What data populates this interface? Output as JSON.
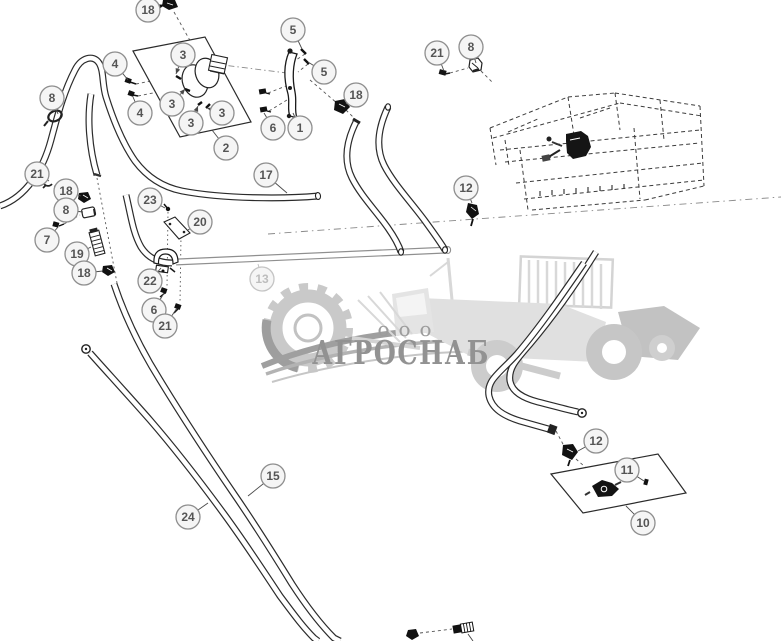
{
  "diagram": {
    "kind": "exploded-parts-diagram",
    "background": "#ffffff",
    "line_color": "#2b2b2b",
    "muted_line_color": "#8f8f8f"
  },
  "watermark": {
    "company_prefix": "ооо",
    "company_name": "АГРОСНАБ",
    "light": "#d9d9d9",
    "mid": "#c7c7c7",
    "dark": "#9a9a9a",
    "text_color": "#929292"
  },
  "callout_style": {
    "radius": 12,
    "fill": "#f5f5f5",
    "stroke": "#8e8e8e",
    "text": "#555555",
    "muted_stroke": "#c4c4c4",
    "muted_text": "#bdbdbd",
    "leader": "#4a4a4a"
  },
  "callouts": [
    {
      "label": "18",
      "x": 148,
      "y": 10,
      "lx": 164,
      "ly": 5,
      "arrow": true,
      "bold": true
    },
    {
      "label": "4",
      "x": 115,
      "y": 64,
      "lx": 128,
      "ly": 80
    },
    {
      "label": "4",
      "x": 140,
      "y": 113,
      "lx": 133,
      "ly": 97
    },
    {
      "label": "3",
      "x": 183,
      "y": 55,
      "lx": 176,
      "ly": 74,
      "arrow": true
    },
    {
      "label": "3",
      "x": 172,
      "y": 104,
      "lx": 185,
      "ly": 89,
      "arrow": true
    },
    {
      "label": "3",
      "x": 191,
      "y": 123,
      "lx": 198,
      "ly": 106,
      "arrow": true
    },
    {
      "label": "3",
      "x": 222,
      "y": 113,
      "lx": 207,
      "ly": 108,
      "arrow": true
    },
    {
      "label": "2",
      "x": 226,
      "y": 148,
      "lx": 212,
      "ly": 130
    },
    {
      "label": "5",
      "x": 293,
      "y": 30,
      "lx": 302,
      "ly": 49
    },
    {
      "label": "5",
      "x": 324,
      "y": 72,
      "lx": 308,
      "ly": 62
    },
    {
      "label": "6",
      "x": 273,
      "y": 128,
      "lx": 264,
      "ly": 113
    },
    {
      "label": "1",
      "x": 300,
      "y": 128,
      "lx": 293,
      "ly": 113
    },
    {
      "label": "18",
      "x": 356,
      "y": 95,
      "lx": 346,
      "ly": 104
    },
    {
      "label": "21",
      "x": 437,
      "y": 53,
      "lx": 444,
      "ly": 71
    },
    {
      "label": "8",
      "x": 471,
      "y": 47,
      "lx": 476,
      "ly": 63
    },
    {
      "label": "12",
      "x": 466,
      "y": 188,
      "lx": 472,
      "ly": 203
    },
    {
      "label": "8",
      "x": 52,
      "y": 98,
      "lx": 58,
      "ly": 114
    },
    {
      "label": "21",
      "x": 37,
      "y": 174,
      "lx": 49,
      "ly": 181
    },
    {
      "label": "18",
      "x": 66,
      "y": 191,
      "lx": 81,
      "ly": 196
    },
    {
      "label": "8",
      "x": 66,
      "y": 210,
      "lx": 83,
      "ly": 212
    },
    {
      "label": "7",
      "x": 47,
      "y": 240,
      "lx": 58,
      "ly": 227
    },
    {
      "label": "19",
      "x": 77,
      "y": 254,
      "lx": 91,
      "ly": 247
    },
    {
      "label": "18",
      "x": 84,
      "y": 273,
      "lx": 103,
      "ly": 271
    },
    {
      "label": "23",
      "x": 150,
      "y": 200,
      "lx": 165,
      "ly": 208
    },
    {
      "label": "20",
      "x": 200,
      "y": 222,
      "lx": 188,
      "ly": 230
    },
    {
      "label": "22",
      "x": 150,
      "y": 281,
      "lx": 161,
      "ly": 268
    },
    {
      "label": "6",
      "x": 154,
      "y": 310,
      "lx": 164,
      "ly": 293
    },
    {
      "label": "21",
      "x": 165,
      "y": 326,
      "lx": 177,
      "ly": 308
    },
    {
      "label": "17",
      "x": 266,
      "y": 175,
      "lx": 287,
      "ly": 193
    },
    {
      "label": "13",
      "x": 262,
      "y": 279,
      "lx": 258,
      "ly": 264,
      "muted": true
    },
    {
      "label": "24",
      "x": 188,
      "y": 517,
      "lx": 208,
      "ly": 503
    },
    {
      "label": "15",
      "x": 273,
      "y": 476,
      "lx": 248,
      "ly": 496
    },
    {
      "label": "12",
      "x": 596,
      "y": 441,
      "lx": 578,
      "ly": 451
    },
    {
      "label": "11",
      "x": 627,
      "y": 470,
      "lx": 644,
      "ly": 481
    },
    {
      "label": "10",
      "x": 643,
      "y": 523,
      "lx": 626,
      "ly": 506
    }
  ]
}
